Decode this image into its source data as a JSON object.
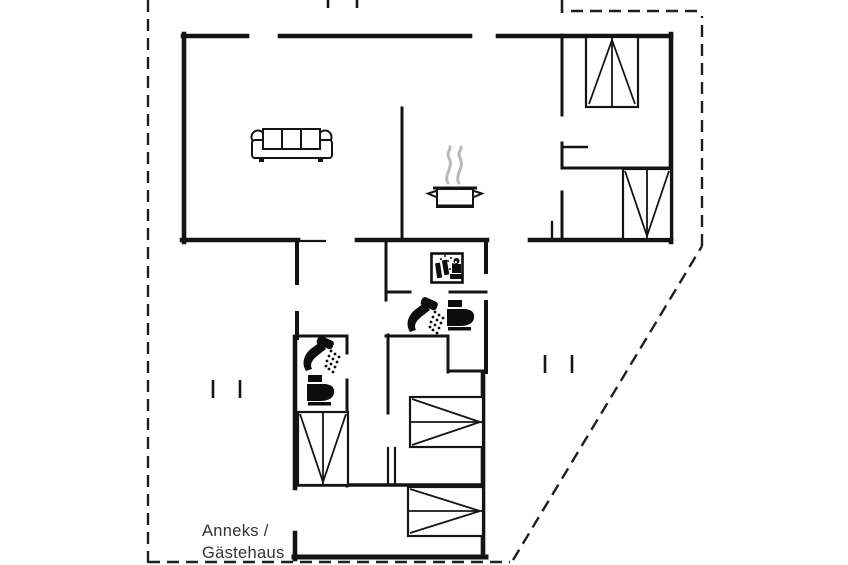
{
  "floor_plan": {
    "annex_label_line1": "Anneks /",
    "annex_label_line2": "Gästehaus",
    "colors": {
      "wall": "#141414",
      "boundary": "#1f1f1f",
      "steam": "#b9b9b9",
      "label": "#333333",
      "icon": "#0d0d0d",
      "background": "#ffffff"
    },
    "icons": [
      {
        "name": "sofa-icon",
        "area": "living-room"
      },
      {
        "name": "cooking-pot-icon",
        "area": "kitchen"
      },
      {
        "name": "steam-icon",
        "area": "kitchen"
      },
      {
        "name": "washing-machine-icon",
        "area": "utility-room"
      },
      {
        "name": "shower-icon-upper",
        "area": "bathroom-1"
      },
      {
        "name": "toilet-icon-upper",
        "area": "bathroom-1"
      },
      {
        "name": "shower-icon-lower",
        "area": "bathroom-2"
      },
      {
        "name": "toilet-icon-lower",
        "area": "bathroom-2"
      },
      {
        "name": "bed-icon-top-right-bedroom",
        "area": "bedroom-1"
      },
      {
        "name": "bed-icon-right-bedroom",
        "area": "bedroom-2"
      },
      {
        "name": "bed-icon-annex",
        "area": "annex-bedroom"
      },
      {
        "name": "bunk-bed-icon-middle",
        "area": "annex-bedroom"
      },
      {
        "name": "bunk-bed-icon-bottom",
        "area": "annex-room"
      }
    ],
    "boundary_style": "dashed-property-line"
  }
}
